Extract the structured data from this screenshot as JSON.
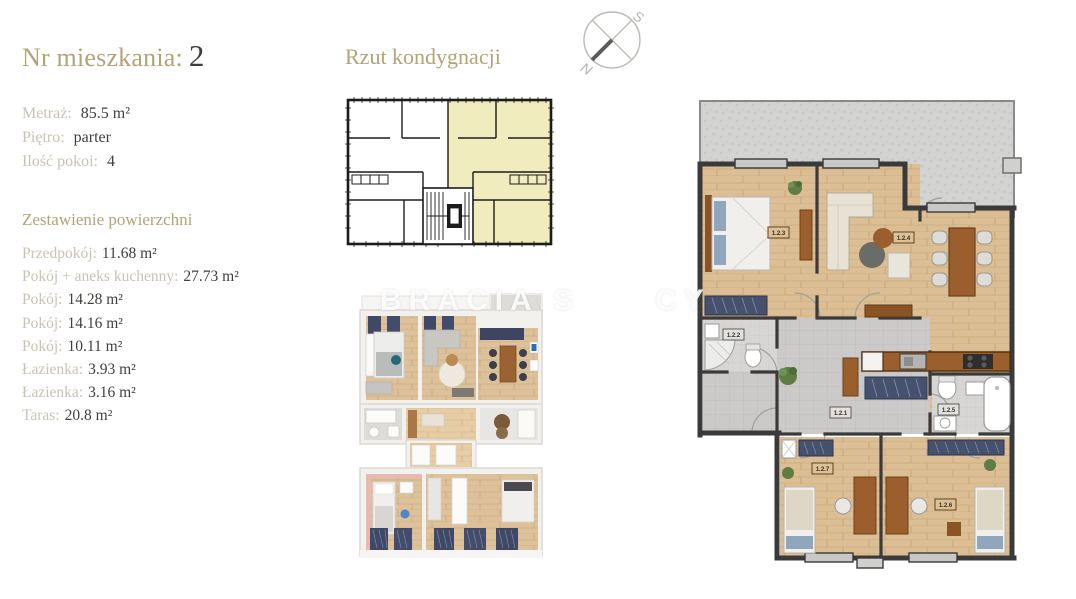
{
  "info": {
    "apartment_label": "Nr mieszkania:",
    "apartment_number": "2",
    "details": [
      {
        "label": "Metraż:",
        "value": "85.5 m²"
      },
      {
        "label": "Piętro:",
        "value": "parter"
      },
      {
        "label": "Ilość pokoi:",
        "value": "4"
      }
    ],
    "areas_heading": "Zestawienie powierzchni",
    "rooms": [
      {
        "label": "Przedpokój:",
        "value": "11.68 m²"
      },
      {
        "label": "Pokój + aneks kuchenny:",
        "value": "27.73 m²"
      },
      {
        "label": "Pokój:",
        "value": "14.28 m²"
      },
      {
        "label": "Pokój:",
        "value": "14.16 m²"
      },
      {
        "label": "Pokój:",
        "value": "10.11 m²"
      },
      {
        "label": "Łazienka:",
        "value": "3.93 m²"
      },
      {
        "label": "Łazienka:",
        "value": "3.16 m²"
      },
      {
        "label": "Taras:",
        "value": "20.8 m²"
      }
    ]
  },
  "floor_section": {
    "heading": "Rzut kondygnacji"
  },
  "compass": {
    "north": "N",
    "south": "S"
  },
  "watermark": {
    "left": "BRACIA S",
    "right": "CY"
  },
  "detailed_plan": {
    "room_labels": [
      "1.2.3",
      "1.2.4",
      "1.2.2",
      "1.2.1",
      "1.2.5",
      "1.2.7",
      "1.2.6"
    ]
  },
  "colors": {
    "accent_gold": "#b2a378",
    "label_gray": "#c8c3b4",
    "value_dark": "#413f3b",
    "unit_highlight_yellow": "#f1ecbe",
    "wood_floor": "#dcbe94",
    "terrace_gray": "#d3d3d1",
    "wall_dark": "#3a3a3a",
    "navy_furniture": "#3f4865"
  }
}
